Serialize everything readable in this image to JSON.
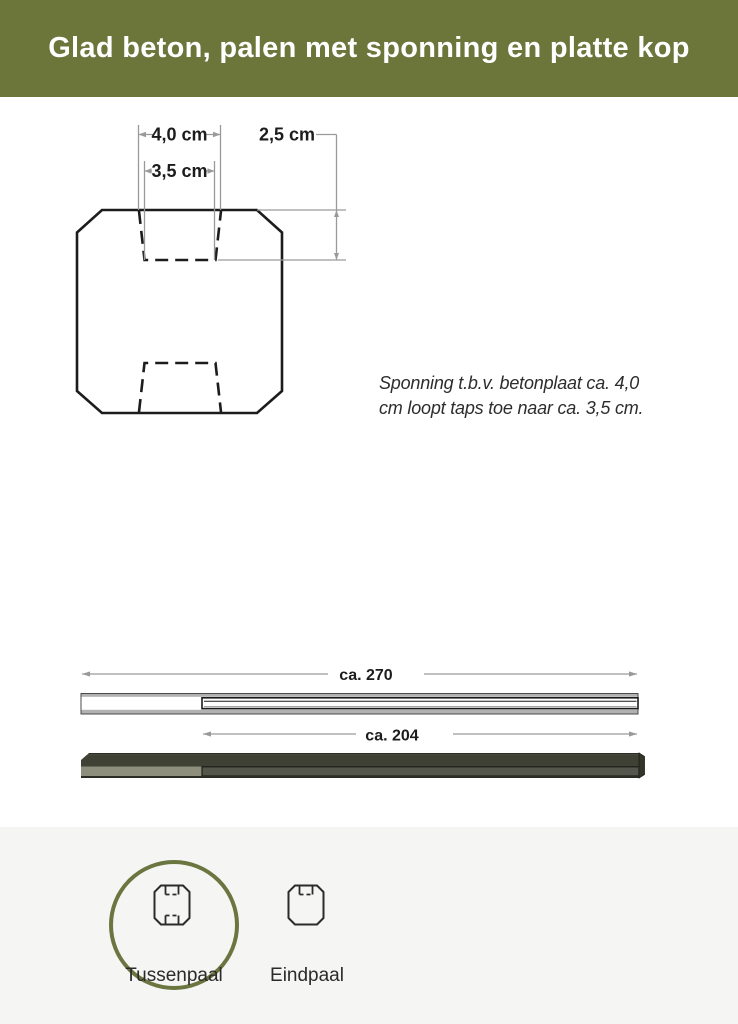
{
  "header": {
    "title": "Glad beton, palen met sponning en platte kop"
  },
  "cross_section": {
    "labels": {
      "top_width": "4,0 cm",
      "taper_width": "3,5 cm",
      "depth": "2,5 cm"
    }
  },
  "annotation": {
    "line1": "Sponning t.b.v. betonplaat ca. 4,0",
    "line2": "cm loopt taps toe naar ca. 3,5 cm."
  },
  "posts": {
    "top_length_label": "ca. 270",
    "bottom_length_label": "ca. 204"
  },
  "variants": {
    "items": [
      {
        "label": "Tussenpaal",
        "icon": "tussenpaal-cross-section-icon",
        "selected": true
      },
      {
        "label": "Eindpaal",
        "icon": "eindpaal-cross-section-icon",
        "selected": false
      }
    ]
  },
  "colors": {
    "header_bg": "#6c763b",
    "header_text": "#ffffff",
    "accent_circle": "#6b7540",
    "footer_bg": "#f5f5f3",
    "outline": "#1c1c1c",
    "dimension_line": "#9a9a9a",
    "dark_post_top": "#3e4134",
    "dark_post_front": "#8d8e7c",
    "dark_post_groove": "#54564b",
    "light_post_bevel": "#b1b1b1"
  }
}
